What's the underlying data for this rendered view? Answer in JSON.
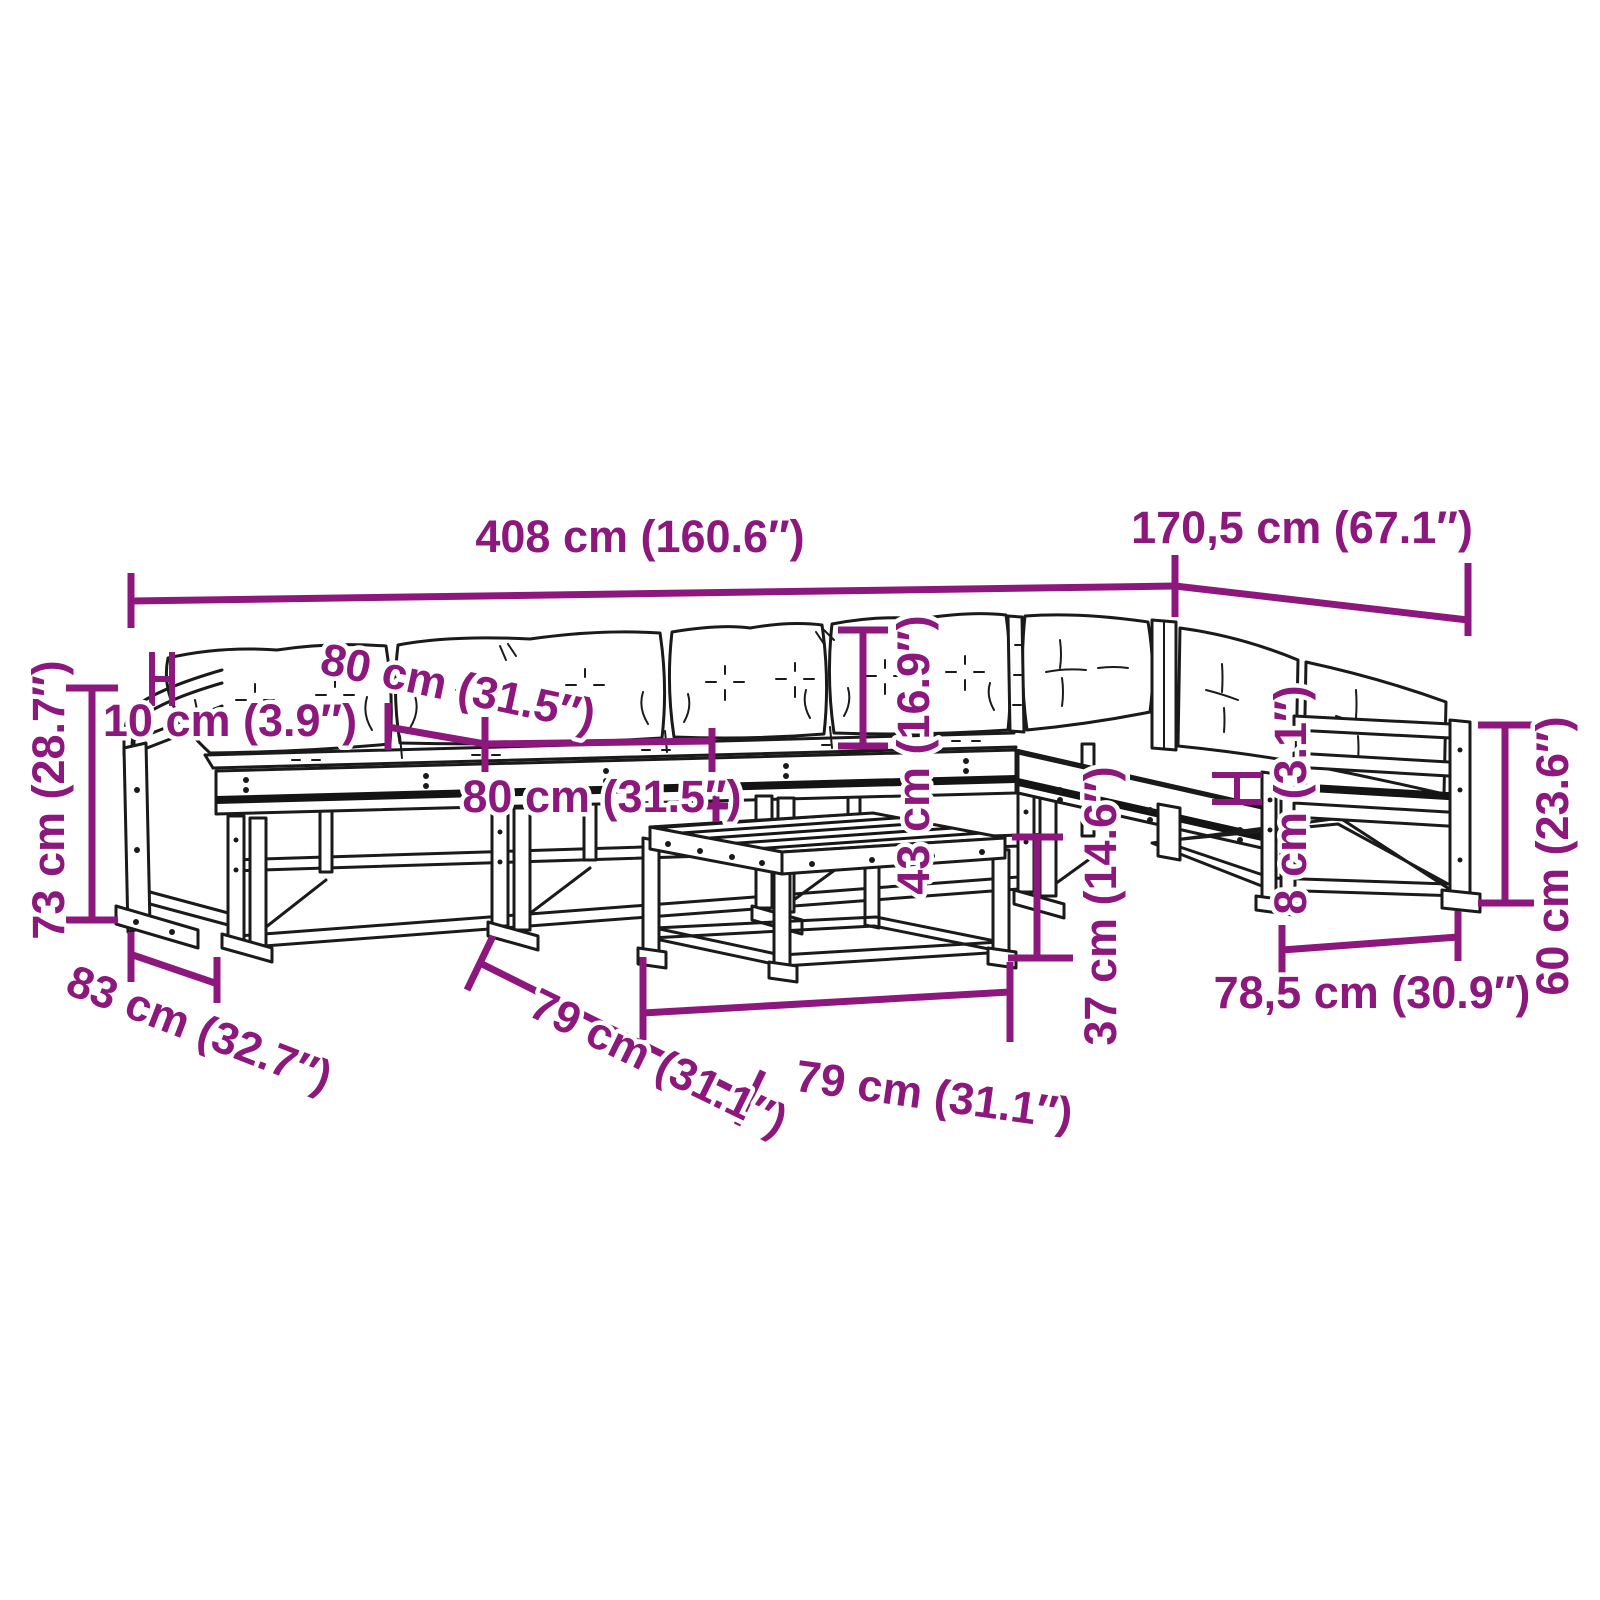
{
  "diagram": {
    "type": "product-dimension-diagram",
    "subject": "garden lounge sofa set with cushions and coffee table",
    "style": "black line art with magenta dimension annotations",
    "unit_primary": "cm",
    "unit_secondary": "in"
  },
  "colors": {
    "annotation": "#8D187D",
    "line_art": "#1A1A1A",
    "background": "#FFFFFF"
  },
  "dimensions": {
    "total_width": {
      "label": "408 cm (160.6″)",
      "cm": "408",
      "in": "160.6"
    },
    "total_depth": {
      "label": "170,5 cm (67.1″)",
      "cm": "170,5",
      "in": "67.1"
    },
    "total_height": {
      "label": "73 cm (28.7″)",
      "cm": "73",
      "in": "28.7"
    },
    "armrest_top_width": {
      "label": "10 cm (3.9″)",
      "cm": "10",
      "in": "3.9"
    },
    "back_cushion_width": {
      "label": "80 cm (31.5″)",
      "cm": "80",
      "in": "31.5"
    },
    "seat_width": {
      "label": "80 cm (31.5″)",
      "cm": "80",
      "in": "31.5"
    },
    "module_depth": {
      "label": "83 cm (32.7″)",
      "cm": "83",
      "in": "32.7"
    },
    "table_side": {
      "label": "79 cm (31.1″)",
      "cm": "79",
      "in": "31.1"
    },
    "table_front": {
      "label": "79 cm (31.1″)",
      "cm": "79",
      "in": "31.1"
    },
    "backrest_height": {
      "label": "43 cm (16.9″)",
      "cm": "43",
      "in": "16.9"
    },
    "table_height": {
      "label": "37 cm (14.6″)",
      "cm": "37",
      "in": "14.6"
    },
    "armrest_thickness": {
      "label": "8 cm (3.1″)",
      "cm": "8",
      "in": "3.1"
    },
    "seat_depth": {
      "label": "78,5 cm (30.9″)",
      "cm": "78,5",
      "in": "30.9"
    },
    "armrest_height": {
      "label": "60 cm (23.6″)",
      "cm": "60",
      "in": "23.6"
    }
  }
}
